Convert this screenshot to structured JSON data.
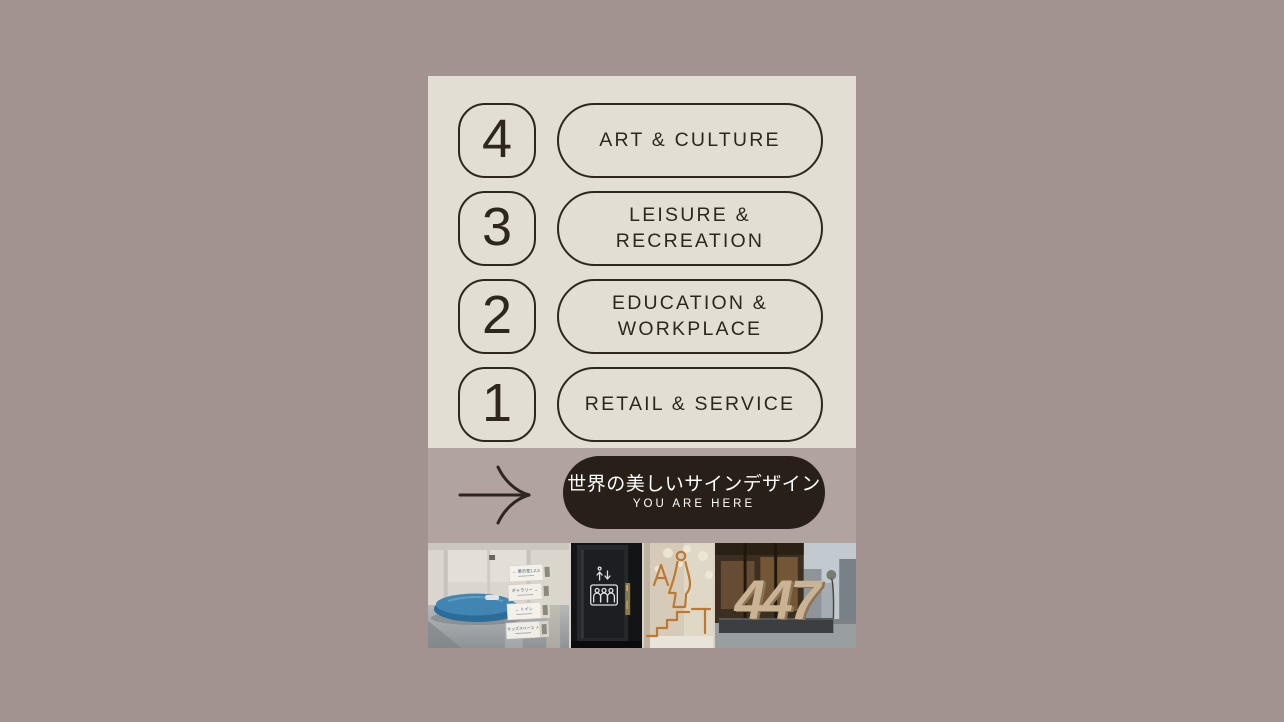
{
  "canvas": {
    "background": "#a29290"
  },
  "poster": {
    "palette": {
      "cream": "#e3ded4",
      "band_mauve": "#b1a39f",
      "ink": "#2e261f",
      "callout_bg": "#281f18",
      "callout_text": "#ffffff",
      "pictogram_orange": "#bd7930",
      "sculpture_sand": "#c9b394"
    },
    "floors": [
      {
        "number": "4",
        "label": "ART & CULTURE"
      },
      {
        "number": "3",
        "label": "LEISURE &\nRECREATION"
      },
      {
        "number": "2",
        "label": "EDUCATION &\nWORKPLACE"
      },
      {
        "number": "1",
        "label": "RETAIL & SERVICE"
      }
    ],
    "callout": {
      "title": "世界の美しいサインデザイン",
      "subtitle": "YOU ARE HERE"
    },
    "photo_strip": {
      "lobby_sign_lines": [
        "← 展示室1,2,3",
        "ギャラリー →",
        "← トイレ",
        "キッズスペース ↗"
      ],
      "sculpture_number": "447"
    }
  }
}
